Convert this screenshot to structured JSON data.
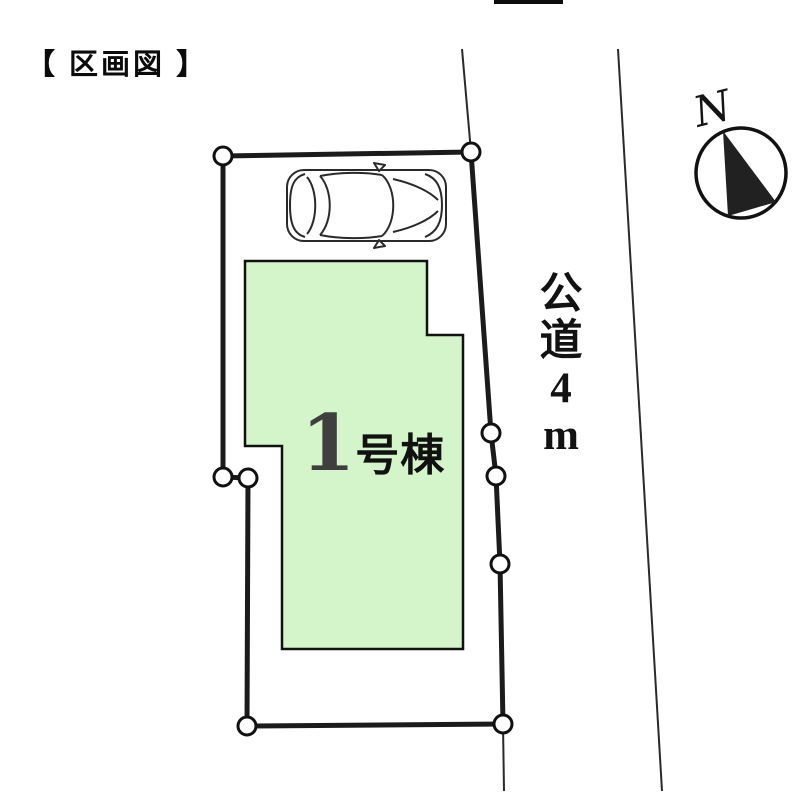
{
  "page": {
    "title": "【 区画図 】"
  },
  "road": {
    "label": "公道4m",
    "chars": [
      "公",
      "道",
      "4",
      "m"
    ]
  },
  "building": {
    "label": "1号棟",
    "number": "1",
    "suffix": "号棟",
    "fill_color": "#d4f5c9"
  },
  "compass": {
    "north_label": "N"
  },
  "colors": {
    "boundary_line": "#1b1b1b",
    "road_line": "#2a2a2a",
    "background": "#ffffff"
  }
}
